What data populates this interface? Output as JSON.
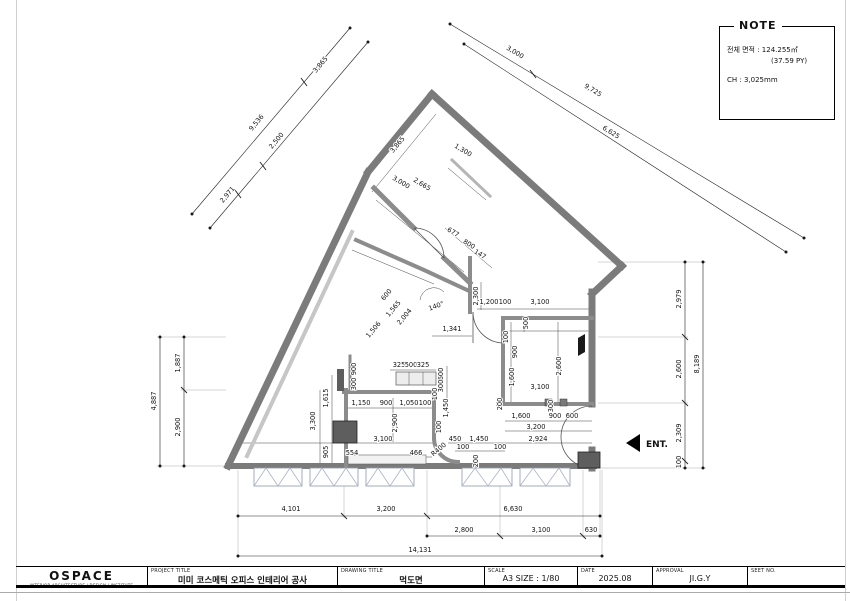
{
  "note": {
    "title": "NOTE",
    "area_line": "전체 면적 : 124.255㎡",
    "area_py_line": "(37.59 PY)",
    "ch_line": "CH : 3,025mm"
  },
  "title_block": {
    "company": "OSPACE",
    "company_sub": "INTERIOR ARCHITECTURE | DESIGN | INSTITUTE",
    "project_title_label": "PROJECT TITLE",
    "project_title": "미미 코스메틱 오피스 인테리어 공사",
    "drawing_title_label": "DRAWING TITLE",
    "drawing_title": "먹도면",
    "scale_label": "SCALE",
    "scale": "A3 SIZE : 1/80",
    "date_label": "DATE",
    "date": "2025.08",
    "approval_label": "APPROVAL",
    "approval": "JI.G.Y",
    "sheet_label": "SEET NO.",
    "sheet": ""
  },
  "plan": {
    "entrance_label": "ENT.",
    "dim_labels": [
      {
        "t": "2,971",
        "x": 229,
        "y": 196,
        "r": -50
      },
      {
        "t": "9,536",
        "x": 258,
        "y": 124,
        "r": -50
      },
      {
        "t": "2,500",
        "x": 278,
        "y": 142,
        "r": -50
      },
      {
        "t": "3,865",
        "x": 322,
        "y": 66,
        "r": -50
      },
      {
        "t": "3,000",
        "x": 514,
        "y": 54,
        "r": 31
      },
      {
        "t": "9,725",
        "x": 592,
        "y": 92,
        "r": 31
      },
      {
        "t": "6,625",
        "x": 610,
        "y": 134,
        "r": 32
      },
      {
        "t": "2,979",
        "x": 681,
        "y": 299,
        "r": -90
      },
      {
        "t": "2,600",
        "x": 681,
        "y": 369,
        "r": -90
      },
      {
        "t": "2,309",
        "x": 681,
        "y": 433,
        "r": -90
      },
      {
        "t": "100",
        "x": 681,
        "y": 462,
        "r": -90
      },
      {
        "t": "8,189",
        "x": 699,
        "y": 364,
        "r": -90
      },
      {
        "t": "1,887",
        "x": 180,
        "y": 363,
        "r": -90
      },
      {
        "t": "2,900",
        "x": 180,
        "y": 427,
        "r": -90
      },
      {
        "t": "4,887",
        "x": 156,
        "y": 401,
        "r": -90
      },
      {
        "t": "4,101",
        "x": 291,
        "y": 511,
        "r": 0
      },
      {
        "t": "3,200",
        "x": 386,
        "y": 511,
        "r": 0
      },
      {
        "t": "6,630",
        "x": 513,
        "y": 511,
        "r": 0
      },
      {
        "t": "2,800",
        "x": 464,
        "y": 532,
        "r": 0
      },
      {
        "t": "3,100",
        "x": 541,
        "y": 532,
        "r": 0
      },
      {
        "t": "630",
        "x": 591,
        "y": 532,
        "r": 0
      },
      {
        "t": "14,131",
        "x": 420,
        "y": 552,
        "r": 0
      },
      {
        "t": "3,865",
        "x": 399,
        "y": 146,
        "r": -50
      },
      {
        "t": "1,300",
        "x": 462,
        "y": 152,
        "r": 31
      },
      {
        "t": "3,000",
        "x": 400,
        "y": 184,
        "r": 31
      },
      {
        "t": "2,665",
        "x": 421,
        "y": 186,
        "r": 31
      },
      {
        "t": "677",
        "x": 452,
        "y": 234,
        "r": 31
      },
      {
        "t": "800",
        "x": 468,
        "y": 246,
        "r": 31
      },
      {
        "t": "147",
        "x": 479,
        "y": 256,
        "r": 31
      },
      {
        "t": "600",
        "x": 388,
        "y": 296,
        "r": -50
      },
      {
        "t": "1,565",
        "x": 395,
        "y": 310,
        "r": -50
      },
      {
        "t": "2,004",
        "x": 406,
        "y": 318,
        "r": -50
      },
      {
        "t": "1,506",
        "x": 375,
        "y": 331,
        "r": -50
      },
      {
        "t": "140°",
        "x": 437,
        "y": 308,
        "r": -20
      },
      {
        "t": "2,300",
        "x": 478,
        "y": 296,
        "r": -90
      },
      {
        "t": "1,200",
        "x": 489,
        "y": 304,
        "r": 0
      },
      {
        "t": "100",
        "x": 505,
        "y": 304,
        "r": 0
      },
      {
        "t": "3,100",
        "x": 540,
        "y": 304,
        "r": 0
      },
      {
        "t": "1,341",
        "x": 452,
        "y": 331,
        "r": 0
      },
      {
        "t": "500",
        "x": 528,
        "y": 323,
        "r": -90
      },
      {
        "t": "100",
        "x": 508,
        "y": 337,
        "r": -90
      },
      {
        "t": "900",
        "x": 517,
        "y": 352,
        "r": -90
      },
      {
        "t": "1,600",
        "x": 514,
        "y": 377,
        "r": -90
      },
      {
        "t": "2,600",
        "x": 561,
        "y": 366,
        "r": -90
      },
      {
        "t": "3,100",
        "x": 540,
        "y": 389,
        "r": 0
      },
      {
        "t": "200",
        "x": 502,
        "y": 404,
        "r": -90
      },
      {
        "t": "300",
        "x": 553,
        "y": 406,
        "r": -90
      },
      {
        "t": "1,600",
        "x": 521,
        "y": 418,
        "r": 0
      },
      {
        "t": "900",
        "x": 555,
        "y": 418,
        "r": 0
      },
      {
        "t": "600",
        "x": 572,
        "y": 418,
        "r": 0
      },
      {
        "t": "3,200",
        "x": 536,
        "y": 429,
        "r": 0
      },
      {
        "t": "2,924",
        "x": 538,
        "y": 441,
        "r": 0
      },
      {
        "t": "450",
        "x": 455,
        "y": 441,
        "r": 0
      },
      {
        "t": "1,450",
        "x": 479,
        "y": 441,
        "r": 0
      },
      {
        "t": "100",
        "x": 463,
        "y": 449,
        "r": 0
      },
      {
        "t": "100",
        "x": 500,
        "y": 449,
        "r": 0
      },
      {
        "t": "200",
        "x": 478,
        "y": 461,
        "r": -90
      },
      {
        "t": "R400",
        "x": 440,
        "y": 451,
        "r": -40
      },
      {
        "t": "1,450",
        "x": 448,
        "y": 408,
        "r": -90
      },
      {
        "t": "100",
        "x": 441,
        "y": 427,
        "r": -90
      },
      {
        "t": "900",
        "x": 356,
        "y": 369,
        "r": -90
      },
      {
        "t": "300",
        "x": 356,
        "y": 384,
        "r": -90
      },
      {
        "t": "325",
        "x": 399,
        "y": 367,
        "r": 0
      },
      {
        "t": "500",
        "x": 411,
        "y": 367,
        "r": 0
      },
      {
        "t": "325",
        "x": 423,
        "y": 367,
        "r": 0
      },
      {
        "t": "600",
        "x": 443,
        "y": 374,
        "r": -90
      },
      {
        "t": "300",
        "x": 443,
        "y": 386,
        "r": -90
      },
      {
        "t": "100",
        "x": 437,
        "y": 394,
        "r": -90
      },
      {
        "t": "1,615",
        "x": 328,
        "y": 398,
        "r": -90
      },
      {
        "t": "3,300",
        "x": 315,
        "y": 421,
        "r": -90
      },
      {
        "t": "1,150",
        "x": 361,
        "y": 405,
        "r": 0
      },
      {
        "t": "900",
        "x": 386,
        "y": 405,
        "r": 0
      },
      {
        "t": "1,050",
        "x": 409,
        "y": 405,
        "r": 0
      },
      {
        "t": "100",
        "x": 425,
        "y": 405,
        "r": 0
      },
      {
        "t": "2,900",
        "x": 397,
        "y": 423,
        "r": -90
      },
      {
        "t": "3,100",
        "x": 383,
        "y": 441,
        "r": 0
      },
      {
        "t": "905",
        "x": 328,
        "y": 452,
        "r": -90
      },
      {
        "t": "554",
        "x": 352,
        "y": 455,
        "r": 0
      },
      {
        "t": "466",
        "x": 416,
        "y": 455,
        "r": 0
      }
    ]
  }
}
